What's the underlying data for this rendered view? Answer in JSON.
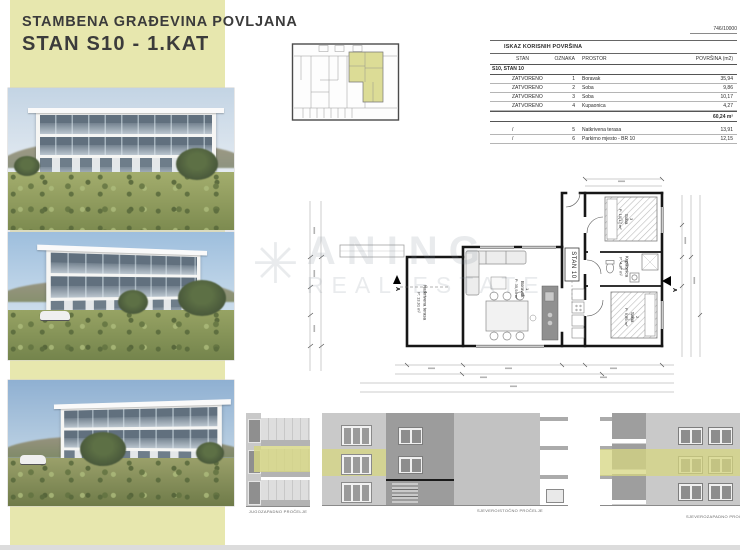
{
  "header": {
    "title_line1": "STAMBENA GRAĐEVINA POVLJANA",
    "title_line2": "STAN S10 - 1.KAT",
    "sheet_number": "746/10000"
  },
  "watermark": {
    "logo_icon": "starburst",
    "line1": "ANING",
    "line2": "REAL ESTATE"
  },
  "area_table": {
    "title": "ISKAZ KORISNIH POVRŠINA",
    "columns": {
      "stan": "STAN",
      "oznaka": "OZNAKA",
      "prostor": "PROSTOR",
      "povrsina": "POVRŠINA (m2)"
    },
    "section_header": "S10, STAN 10",
    "rows": [
      {
        "stan": "ZATVORENO",
        "oznaka": "1",
        "prostor": "Boravak",
        "povrsina": "35,94"
      },
      {
        "stan": "ZATVORENO",
        "oznaka": "2",
        "prostor": "Soba",
        "povrsina": "9,86"
      },
      {
        "stan": "ZATVORENO",
        "oznaka": "3",
        "prostor": "Soba",
        "povrsina": "10,17"
      },
      {
        "stan": "ZATVORENO",
        "oznaka": "4",
        "prostor": "Kupaonica",
        "povrsina": "4,27"
      }
    ],
    "subtotal": "60,24 m²",
    "open_rows": [
      {
        "stan": "/",
        "oznaka": "5",
        "prostor": "Natkrivena terasa",
        "povrsina": "13,91"
      },
      {
        "stan": "/",
        "oznaka": "6",
        "prostor": "Parkirno mjesto - BR 10",
        "povrsina": "12,15"
      }
    ]
  },
  "floor_plan": {
    "unit_label": "STAN 10",
    "section_marker": "A",
    "rooms": {
      "terasa": {
        "name": "Natkrivena terasa",
        "area": "P: 13,91 m²"
      },
      "boravak": {
        "num": "1",
        "name": "Boravak",
        "area": "P: 35,94 m²"
      },
      "soba3": {
        "num": "3",
        "name": "Soba",
        "area": "P: 10,17 m²"
      },
      "kupaonica": {
        "num": "4",
        "name": "Kupaonica",
        "area": "P: 4,27 m²"
      },
      "soba2": {
        "num": "2",
        "name": "Soba",
        "area": "P: 9,86 m²"
      }
    }
  },
  "elevations": {
    "southwest": "JUGOZAPADNO PROČELJE",
    "northeast": "SJEVEROISTOČNO PROČELJE",
    "northwest": "SJEVEROZAPADNO PROČELJE"
  },
  "colors": {
    "band": "#e7e7ae",
    "highlight": "#d5d582"
  }
}
